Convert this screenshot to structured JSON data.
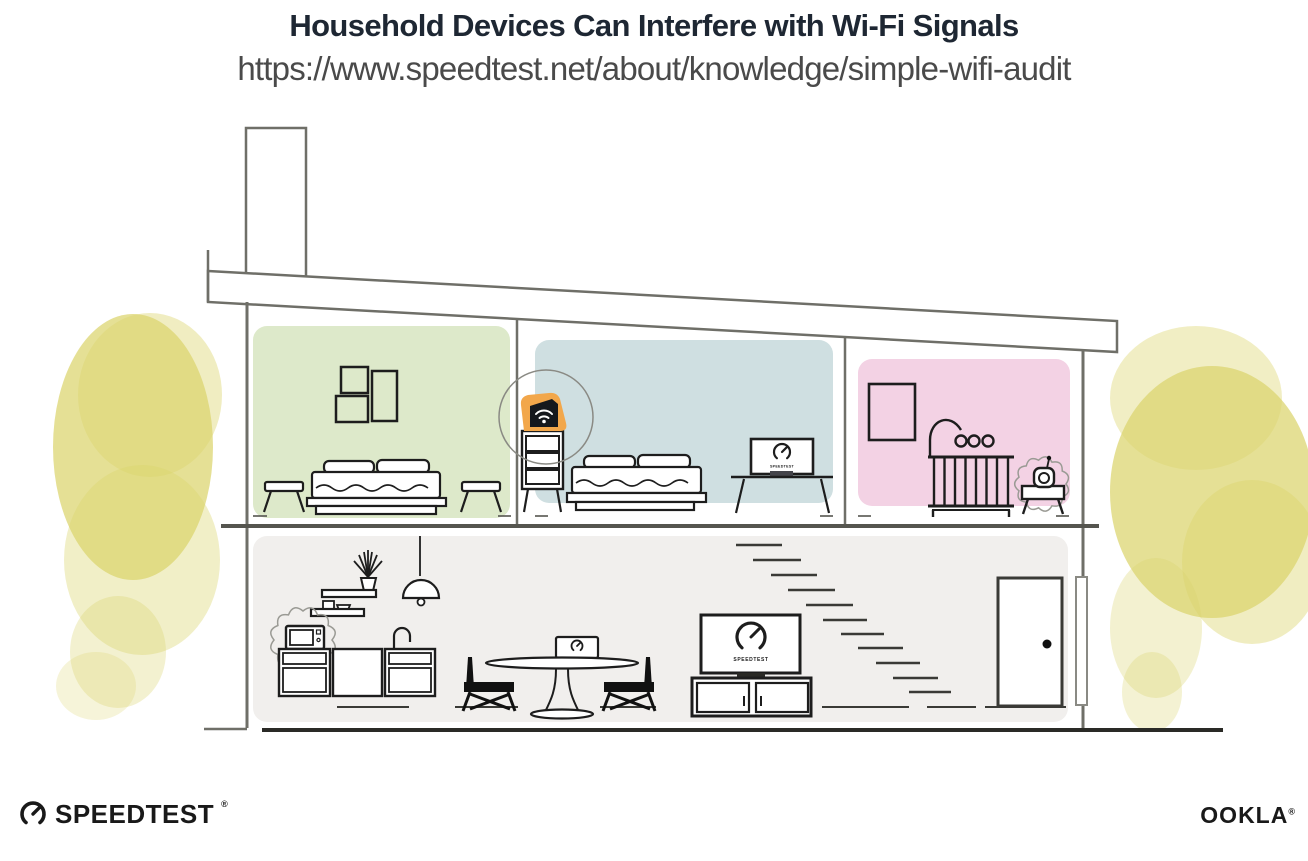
{
  "header": {
    "title": "Household Devices Can Interfere with Wi-Fi Signals",
    "url": "https://www.speedtest.net/about/knowledge/simple-wifi-audit"
  },
  "branding": {
    "speedtest_wordmark": "SPEEDTEST",
    "speedtest_trademark": "®",
    "ookla_wordmark": "OOKLA",
    "ookla_trademark": "®"
  },
  "illustration": {
    "device_screens_brand_label": "SPEEDTEST",
    "colors": {
      "router_highlight_orange": "#F2A74B",
      "router_body_black": "#15181D",
      "bedroom_green": "#DDE9CA",
      "bedroom_blue": "#CFDFE1",
      "nursery_pink": "#F3D2E4",
      "downstairs_gray": "#F1EFED",
      "foliage_yellow": "#DBD46C",
      "structure_line_gray": "#6F6F68",
      "ink_black": "#1D1D1D"
    }
  }
}
